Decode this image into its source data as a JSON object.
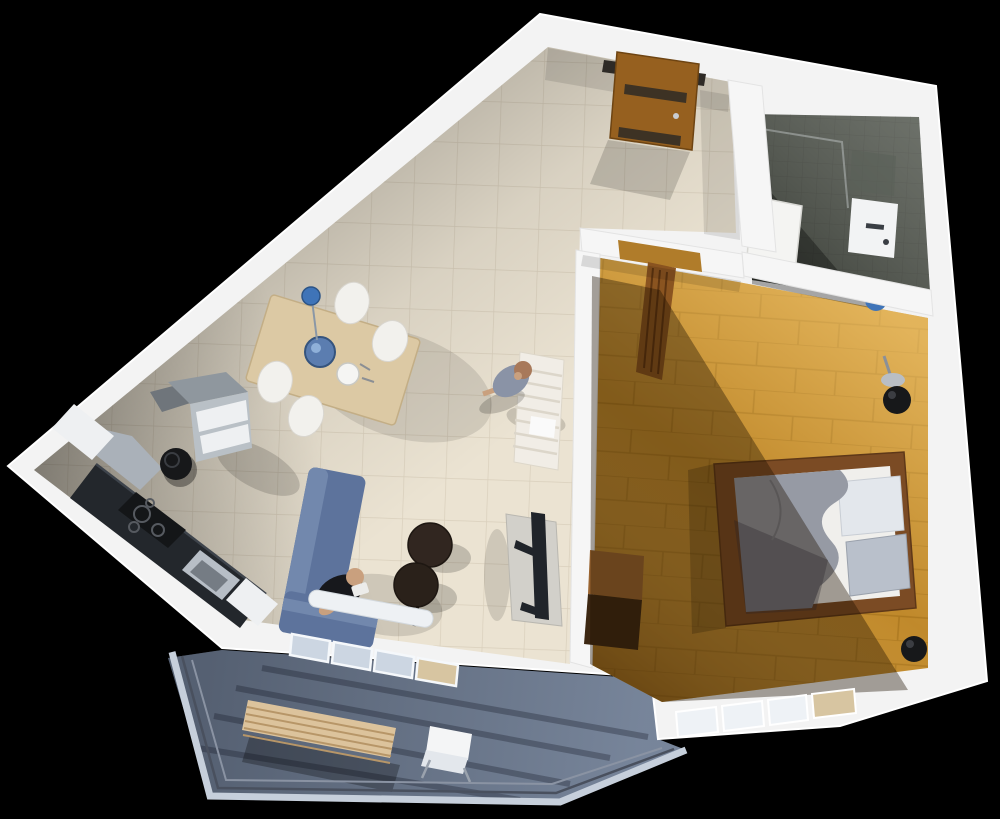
{
  "scene": {
    "description": "3D isometric render of a one-bedroom apartment floor plan on a black background",
    "rooms": [
      {
        "name": "living-dining-room",
        "floor": "beige ceramic tile"
      },
      {
        "name": "kitchen",
        "floor": "beige ceramic tile"
      },
      {
        "name": "hallway",
        "floor": "beige ceramic tile"
      },
      {
        "name": "bedroom",
        "floor": "wood planks"
      },
      {
        "name": "bathroom",
        "floor": "dark slate tile"
      },
      {
        "name": "balcony",
        "floor": "blue-gray decking"
      }
    ],
    "furniture": {
      "hallway": [
        "entry-door-open",
        "white-slatted-bench"
      ],
      "living_dining": [
        "dining-table",
        "four-white-chairs",
        "blue-pendant-lamp",
        "blue-fruit-bowl",
        "place-setting",
        "blue-l-shaped-sofa",
        "two-round-coffee-tables",
        "tv-stand",
        "flatscreen-tv",
        "radiator",
        "sliding-glass-balcony-door"
      ],
      "kitchen": [
        "dark-counter",
        "cooktop",
        "sink",
        "range-hood",
        "upper-cabinets",
        "fridge",
        "trash-bin"
      ],
      "bedroom": [
        "double-bed",
        "gray-blanket",
        "pillows",
        "wood-dresser",
        "black-sphere-floor-lamp",
        "black-sphere-lamp-corner",
        "window-wall"
      ],
      "bathroom": [
        "open-white-door",
        "wall-sink",
        "blue-toilet",
        "shower-glass"
      ],
      "balcony": [
        "wood-slat-bench",
        "white-chair",
        "metal-railing"
      ]
    },
    "people": [
      {
        "name": "man-sitting-on-sofa"
      },
      {
        "name": "woman-standing-in-hallway"
      }
    ]
  },
  "colors": {
    "background": "#000000",
    "shell_wall": "#f3f3f3",
    "inner_wall": "#f6f6f6",
    "tile_floor": "#ebe3d2",
    "tile_line": "#d9cfbc",
    "wood_floor": "#c0892b",
    "bath_floor": "#4b5047",
    "balcony_floor": "#7d8ba1",
    "railing_light": "#c6cfdb",
    "railing_dark": "#49505e",
    "door_wood": "#96601f",
    "door_dark": "#2e2a26",
    "dining_table": "#dcc9a4",
    "chair_white": "#f2f1ed",
    "pendant_blue": "#3f74b8",
    "bowl_blue": "#5b7db0",
    "counter_dark": "#23272c",
    "cooktop_black": "#141618",
    "steel": "#aab1b9",
    "cabinet_white": "#eef0f2",
    "fridge_gray": "#b9c0c6",
    "bin_black": "#17181a",
    "sofa_blue": "#5d739c",
    "sofa_blue_light": "#7288ad",
    "coffee_table": "#312620",
    "tv_stand": "#d2d0ca",
    "tv_black": "#20242a",
    "bed_frame": "#7b4b24",
    "mattress": "#f0efec",
    "blanket": "#969aa4",
    "pillow_light": "#e3e7ec",
    "pillow_dark": "#b9c0cb",
    "dresser_top": "#9a6430",
    "dresser_front": "#3c2712",
    "lamp_black": "#17181a",
    "hall_bench": "#f1ede6",
    "bench_wood": "#dcc39c",
    "sink_white": "#f2f3f4",
    "toilet_blue": "#3f74b8",
    "skin": "#c9a07e",
    "man_shirt": "#17181c",
    "woman_dress": "#8a93a6",
    "woman_hair": "#a8795a",
    "window_beige": "#d7c5a1",
    "glass": "#ccd6e2",
    "radiator": "#eef1f4"
  }
}
